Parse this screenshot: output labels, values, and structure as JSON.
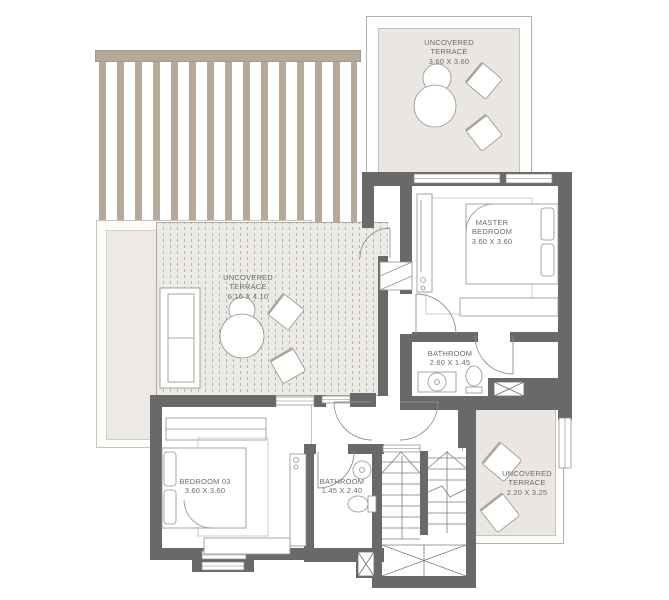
{
  "plan": {
    "type": "residential-floor-plan-upper-level",
    "colors": {
      "wall": "#696969",
      "pergola": "#b6a99a",
      "terrace_fill": "#eae7e2",
      "deck_fill": "#eceae5",
      "deck_line": "#b8b2a7",
      "furniture_line": "#90908c",
      "label_text": "#6b6b6b"
    },
    "rooms": [
      {
        "id": "terrace-top",
        "name": "UNCOVERED\nTERRACE",
        "dims": "3.60 X 3.60"
      },
      {
        "id": "master-bedroom",
        "name": "MASTER\nBEDROOM",
        "dims": "3.60 X 3.60"
      },
      {
        "id": "bathroom-upper",
        "name": "BATHROOM",
        "dims": "2.60 X 1.45"
      },
      {
        "id": "terrace-main",
        "name": "UNCOVERED\nTERRACE",
        "dims": "6.10 X 4.10"
      },
      {
        "id": "bedroom-03",
        "name": "BEDROOM 03",
        "dims": "3.60 X 3.60"
      },
      {
        "id": "bathroom-lower",
        "name": "BATHROOM",
        "dims": "1.45 X 2.40"
      },
      {
        "id": "terrace-bottom",
        "name": "UNCOVERED\nTERRACE",
        "dims": "2.20 X 3.25"
      }
    ],
    "features": [
      "pergola",
      "deck-boards",
      "u-shaped-staircase",
      "shaft-x-boxes",
      "door-swings",
      "windows"
    ]
  }
}
